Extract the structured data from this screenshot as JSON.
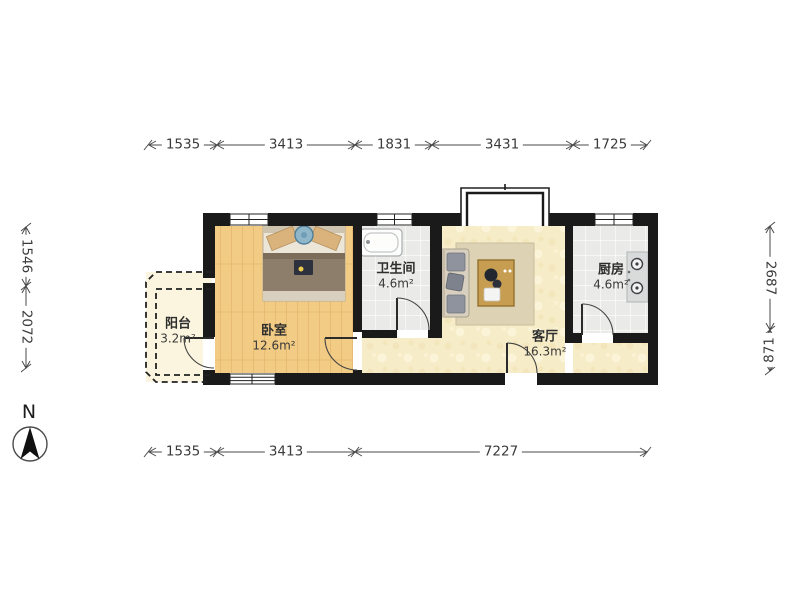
{
  "plan": {
    "compass": {
      "label": "N"
    },
    "rooms": [
      {
        "id": "balcony",
        "name": "阳台",
        "area": "3.2m²"
      },
      {
        "id": "bedroom",
        "name": "卧室",
        "area": "12.6m²"
      },
      {
        "id": "bathroom",
        "name": "卫生间",
        "area": "4.6m²"
      },
      {
        "id": "living",
        "name": "客厅",
        "area": "16.3m²"
      },
      {
        "id": "kitchen",
        "name": "厨房",
        "area": "4.6m²"
      }
    ],
    "dimensions": {
      "top": [
        "1535",
        "3413",
        "1831",
        "3431",
        "1725"
      ],
      "bottom": [
        "1535",
        "3413",
        "7227"
      ],
      "left": [
        "1546",
        "2072"
      ],
      "right": [
        "2687",
        "871"
      ]
    },
    "colors": {
      "wall": "#1a1a1a",
      "wood_floor": "#f2cb84",
      "tile_floor": "#eaeae8",
      "living_floor": "#f7ecc8",
      "balcony_floor": "#fbf5df",
      "dimension_line": "#4a4a4a"
    }
  }
}
